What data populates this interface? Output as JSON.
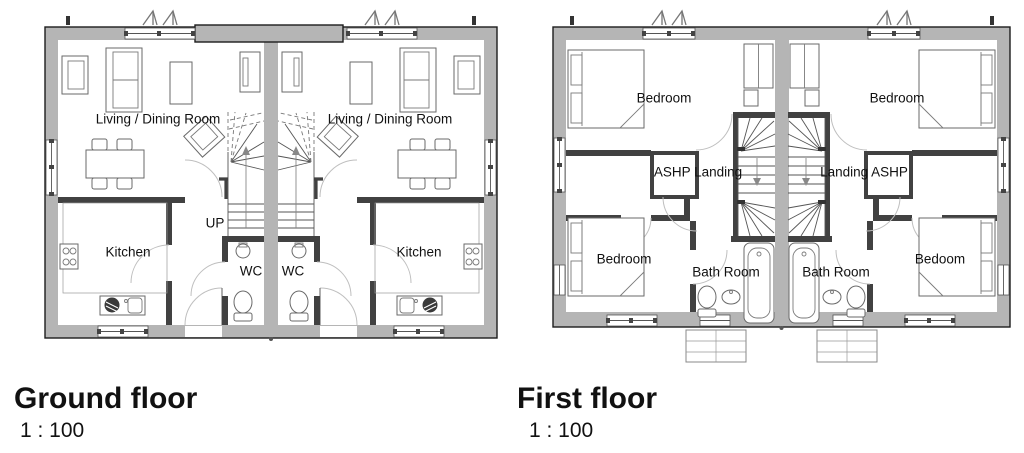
{
  "colors": {
    "outer_wall": "#b5b5b5",
    "interior_wall": "#414141",
    "wall_outline": "#1c1c1c",
    "label_text": "#111111",
    "background": "#ffffff"
  },
  "icons": {
    "vent": "roof-vent-chevrons"
  },
  "ground_floor": {
    "title": "Ground floor",
    "scale": "1 : 100",
    "labels": {
      "living_left": "Living / Dining Room",
      "living_right": "Living / Dining Room",
      "kitchen_left": "Kitchen",
      "kitchen_right": "Kitchen",
      "up": "UP",
      "wc_left": "WC",
      "wc_right": "WC"
    }
  },
  "first_floor": {
    "title": "First floor",
    "scale": "1 : 100",
    "labels": {
      "bedroom_top_left": "Bedroom",
      "bedroom_top_right": "Bedroom",
      "landing_left": "ASHP Landing",
      "landing_right": "Landing ASHP",
      "bedroom_bottom_left": "Bedroom",
      "bath_left": "Bath Room",
      "bath_right": "Bath Room",
      "bedroom_bottom_right": "Bedoom"
    }
  }
}
